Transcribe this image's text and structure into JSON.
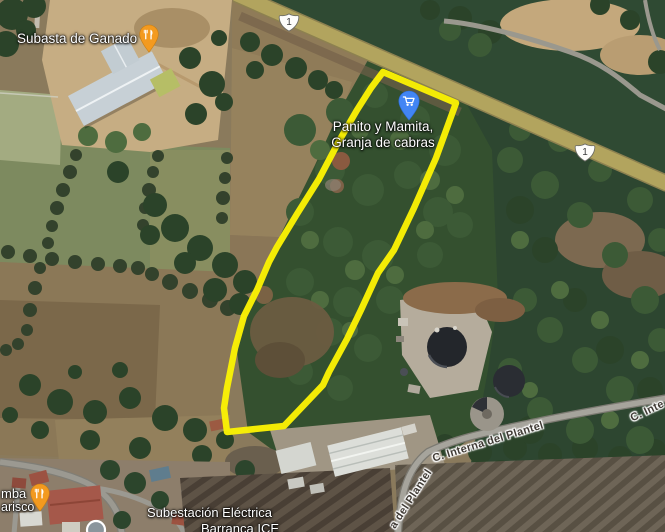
{
  "map": {
    "view_type": "satellite",
    "parcel_polygon_points": "383,72 456,103 436,158 414,208 394,250 378,273 361,310 347,339 329,372 323,385 284,426 227,432 224,408 227,388 235,348 244,316 257,290 269,262 277,247 297,214 319,179 339,141 357,110 371,88",
    "parcel_outline_color": "#FAF104",
    "pin_colors": {
      "restaurant": "#F39A1F",
      "shopping": "#4285F4",
      "generic": "#8A959C"
    },
    "road_colors": {
      "highway": "#B2A45E",
      "minor": "#A6A49C"
    }
  },
  "pois": {
    "subasta": {
      "label": "Subasta de Ganado",
      "icon": "restaurant-pin"
    },
    "panito": {
      "label_line1": "Panito y Mamita,",
      "label_line2": "Granja de cabras",
      "icon": "shopping-cart-pin"
    },
    "marisco_partial": {
      "label_line1": "mba",
      "label_line2": "arisco",
      "icon": "restaurant-pin"
    },
    "subestacion": {
      "label_line1": "Subestación Eléctrica",
      "label_line2": "Barranca ICE"
    }
  },
  "roads": {
    "route1_shield": "1",
    "interna_del_plantel": "C. Interna del Plantel",
    "interna_partial": "C. Inte",
    "del_plantel_partial": "a del Plantel"
  }
}
